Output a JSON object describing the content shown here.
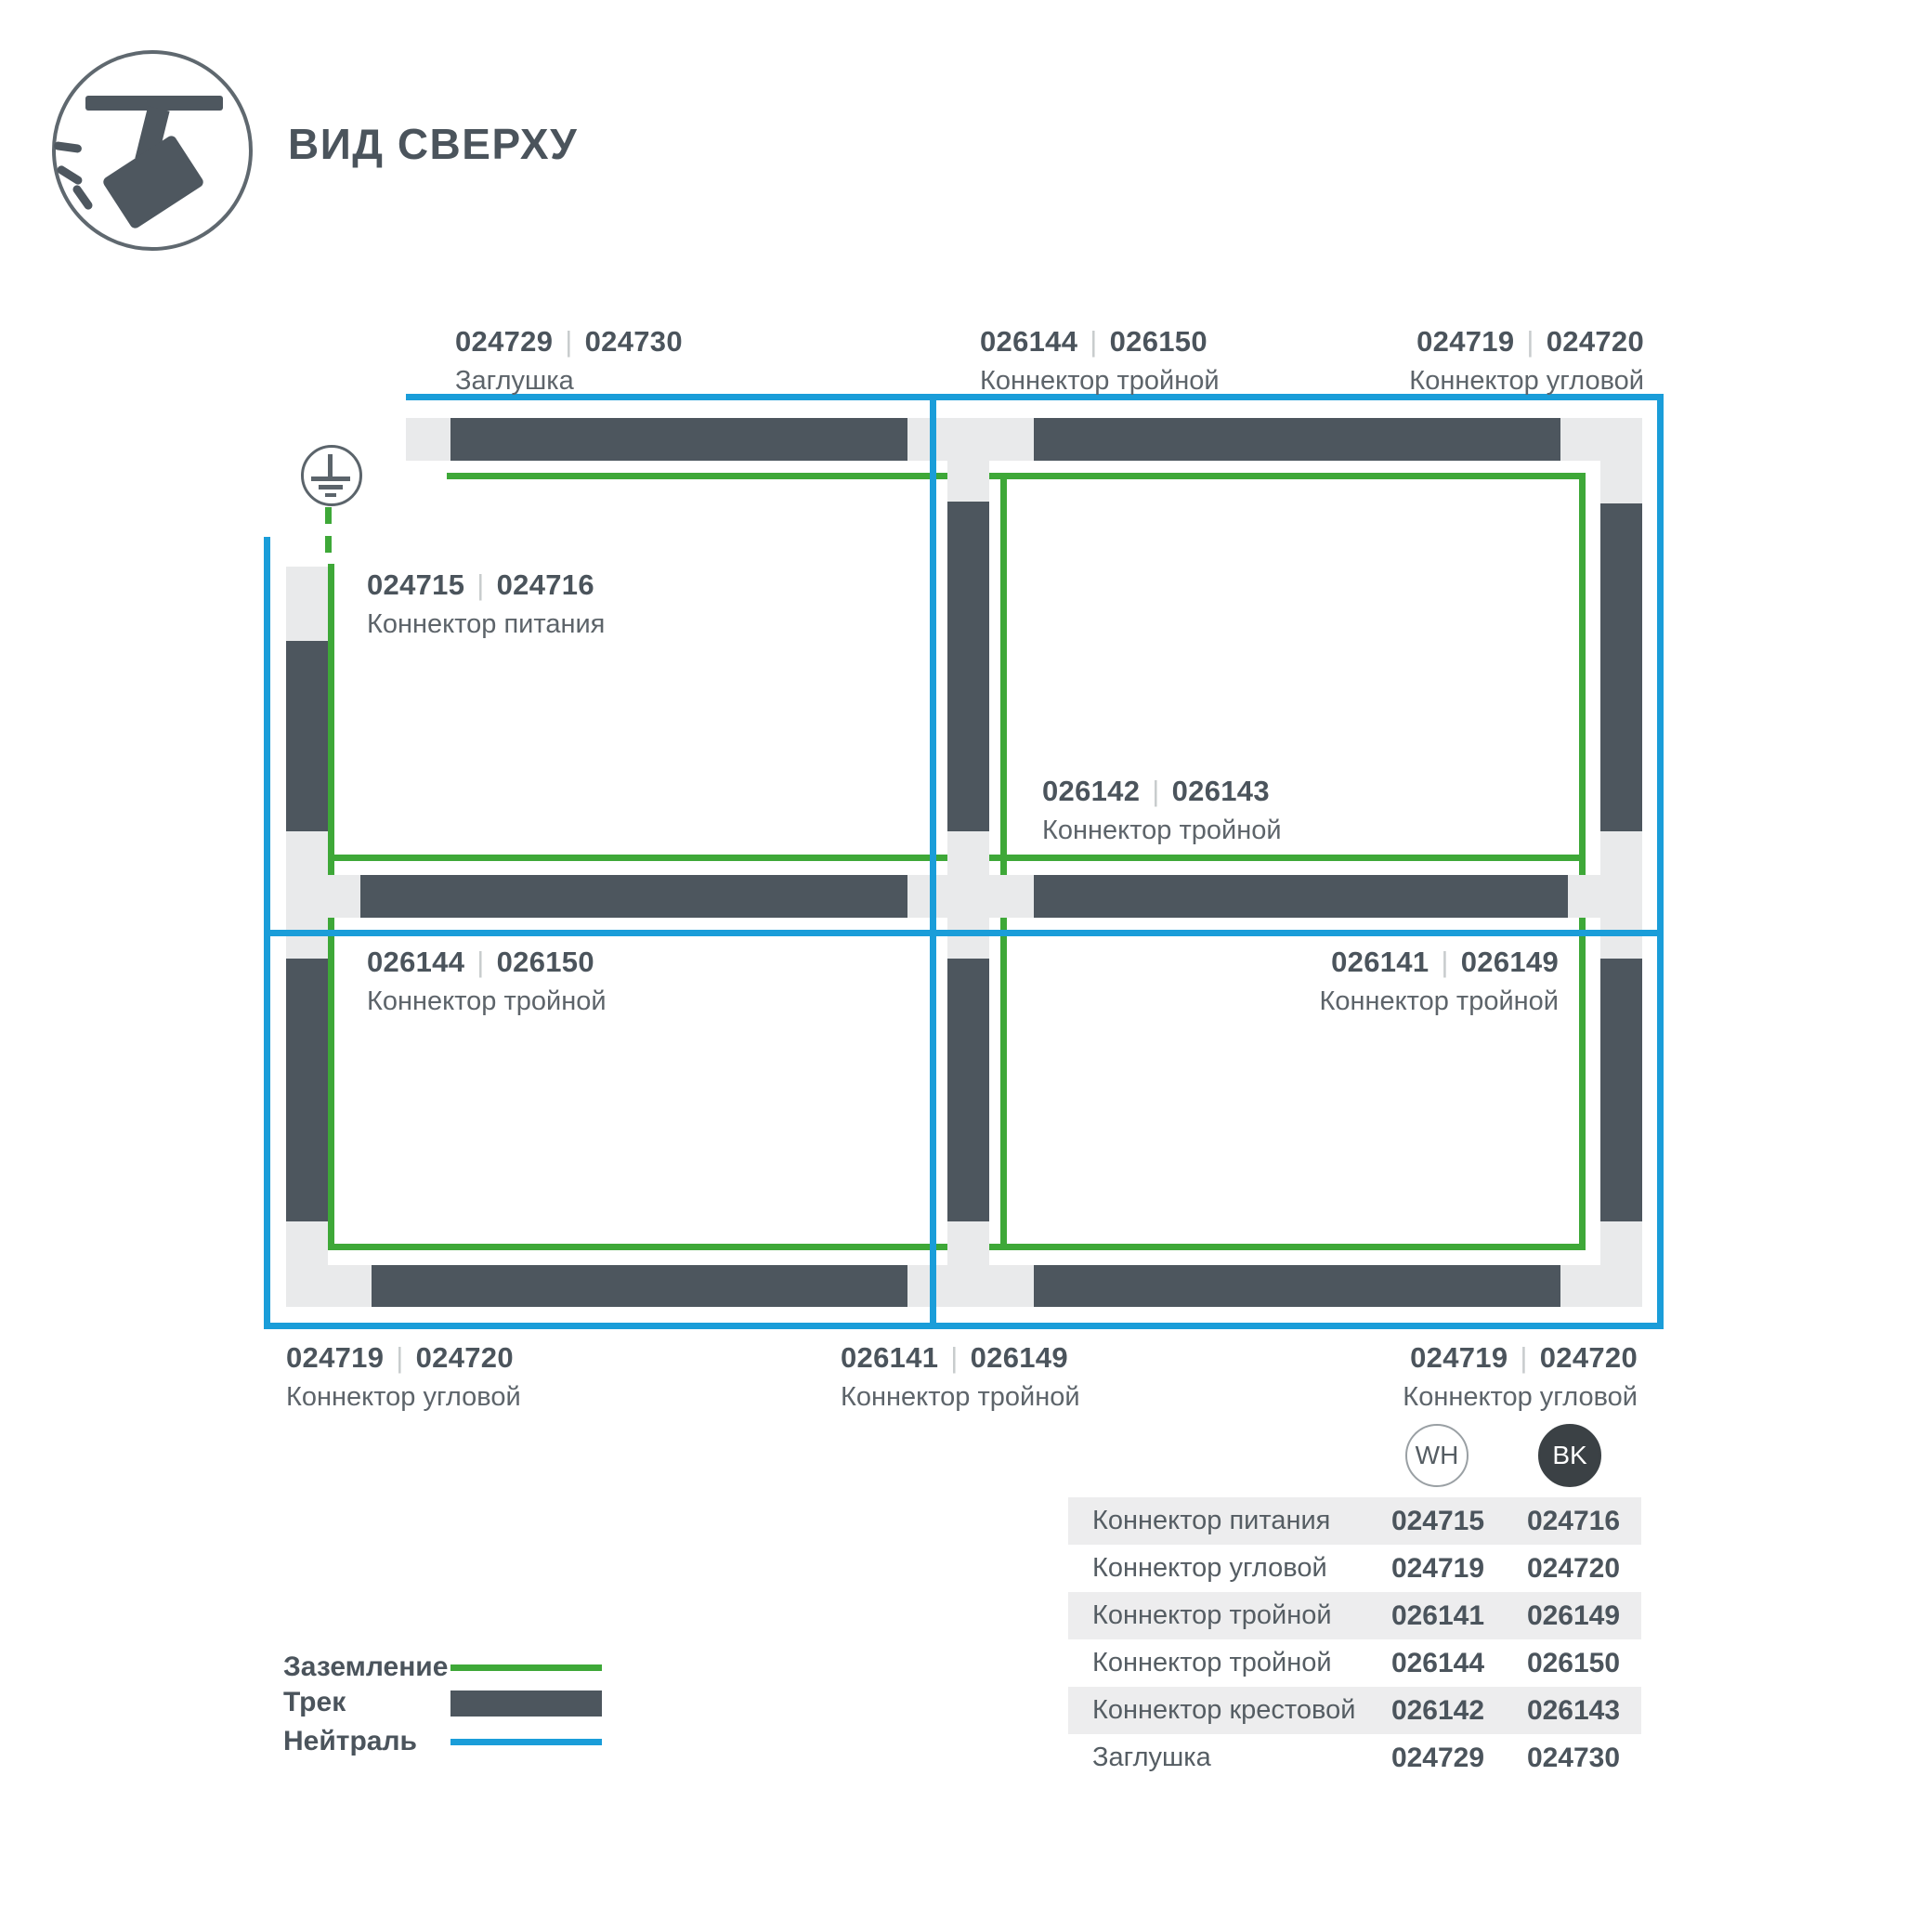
{
  "header": {
    "title": "ВИД СВЕРХУ"
  },
  "colors": {
    "track_dark": "#4d565e",
    "track_light": "#e9eaeb",
    "ground_green": "#3ea838",
    "neutral_blue": "#1a9dd9",
    "bk_badge": "#3b4145"
  },
  "diagram": {
    "code_separator": "|",
    "labels": [
      {
        "wh": "024729",
        "bk": "024730",
        "name": "Заглушка"
      },
      {
        "wh": "026144",
        "bk": "026150",
        "name": "Коннектор тройной"
      },
      {
        "wh": "024719",
        "bk": "024720",
        "name": "Коннектор угловой"
      },
      {
        "wh": "024715",
        "bk": "024716",
        "name": "Коннектор питания"
      },
      {
        "wh": "026142",
        "bk": "026143",
        "name": "Коннектор тройной"
      },
      {
        "wh": "026144",
        "bk": "026150",
        "name": "Коннектор тройной"
      },
      {
        "wh": "026141",
        "bk": "026149",
        "name": "Коннектор тройной"
      },
      {
        "wh": "024719",
        "bk": "024720",
        "name": "Коннектор угловой"
      },
      {
        "wh": "026141",
        "bk": "026149",
        "name": "Коннектор тройной"
      },
      {
        "wh": "024719",
        "bk": "024720",
        "name": "Коннектор угловой"
      }
    ]
  },
  "legend": {
    "items": [
      {
        "label": "Заземление",
        "swatch": "ground-line"
      },
      {
        "label": "Трек",
        "swatch": "track-bar"
      },
      {
        "label": "Нейтраль",
        "swatch": "neutral-line"
      }
    ]
  },
  "table": {
    "columns": [
      "WH",
      "BK"
    ],
    "rows": [
      {
        "name": "Коннектор питания",
        "wh": "024715",
        "bk": "024716"
      },
      {
        "name": "Коннектор угловой",
        "wh": "024719",
        "bk": "024720"
      },
      {
        "name": "Коннектор тройной",
        "wh": "026141",
        "bk": "026149"
      },
      {
        "name": "Коннектор тройной",
        "wh": "026144",
        "bk": "026150"
      },
      {
        "name": "Коннектор крестовой",
        "wh": "026142",
        "bk": "026143"
      },
      {
        "name": "Заглушка",
        "wh": "024729",
        "bk": "024730"
      }
    ]
  }
}
